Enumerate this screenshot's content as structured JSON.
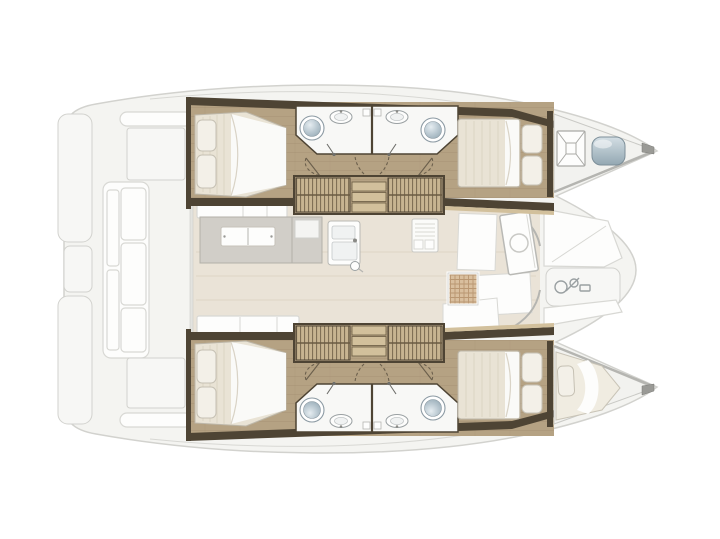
{
  "diagram": {
    "type": "floorplan",
    "subject": "catamaran-deck-plan",
    "description": "Top-down interior layout plan of a four-cabin sailing catamaran, bow facing right",
    "aria_label": "Catamaran interior floor plan"
  },
  "colors": {
    "bg": "#ffffff",
    "deck": "#f4f4f1",
    "deckLine": "#d2d2ce",
    "wall": "#4e4434",
    "wood": "#b5a283",
    "woodGrain": "#9f8b6c",
    "woodLight": "#d2c09c",
    "tread": "#c7b491",
    "treadLine": "#6a5b43",
    "bathFloor": "#f8f8f6",
    "toilet": "#b7c6cf",
    "toiletRim": "#8c9aa3",
    "bedDuvet": "#e9e3d5",
    "bedSheet": "#fafaf8",
    "pillow": "#f3f0e8",
    "pillowLine": "#c6c1b4",
    "saloonFloor": "#eae3d7",
    "saloonLine": "#dcd4c3",
    "tableGray": "#d1cec8",
    "tableLine": "#b3b0a9",
    "mesh": "#d9bf9e",
    "meshLine": "#b28d67",
    "steel": "#a9bac4",
    "steelDark": "#7d8f99",
    "white": "#fdfdfc",
    "lightLine": "#d8d8d4",
    "midLine": "#b5b5b1",
    "arc": "#6b5f4c",
    "fixture": "#9aa0a2"
  },
  "features": {
    "aft_deck": [
      "swim-platforms",
      "transom-bench",
      "cockpit-pads"
    ],
    "port_hull": [
      "aft-cabin-double-bed",
      "head-toilet-sink",
      "companionway-steps",
      "forward-cabin-double-bed",
      "forepeak-hatch",
      "forepeak-liferaft"
    ],
    "starboard_hull": [
      "aft-cabin-double-bed",
      "head-toilet-sink",
      "companionway-steps",
      "forward-cabin-double-bed",
      "forepeak-berth"
    ],
    "saloon": [
      "dinette-table",
      "bench-seats",
      "galley-double-sink",
      "galley-appliance",
      "forward-door"
    ],
    "foredeck": [
      "lounge-pads",
      "anchor-windlass"
    ]
  }
}
